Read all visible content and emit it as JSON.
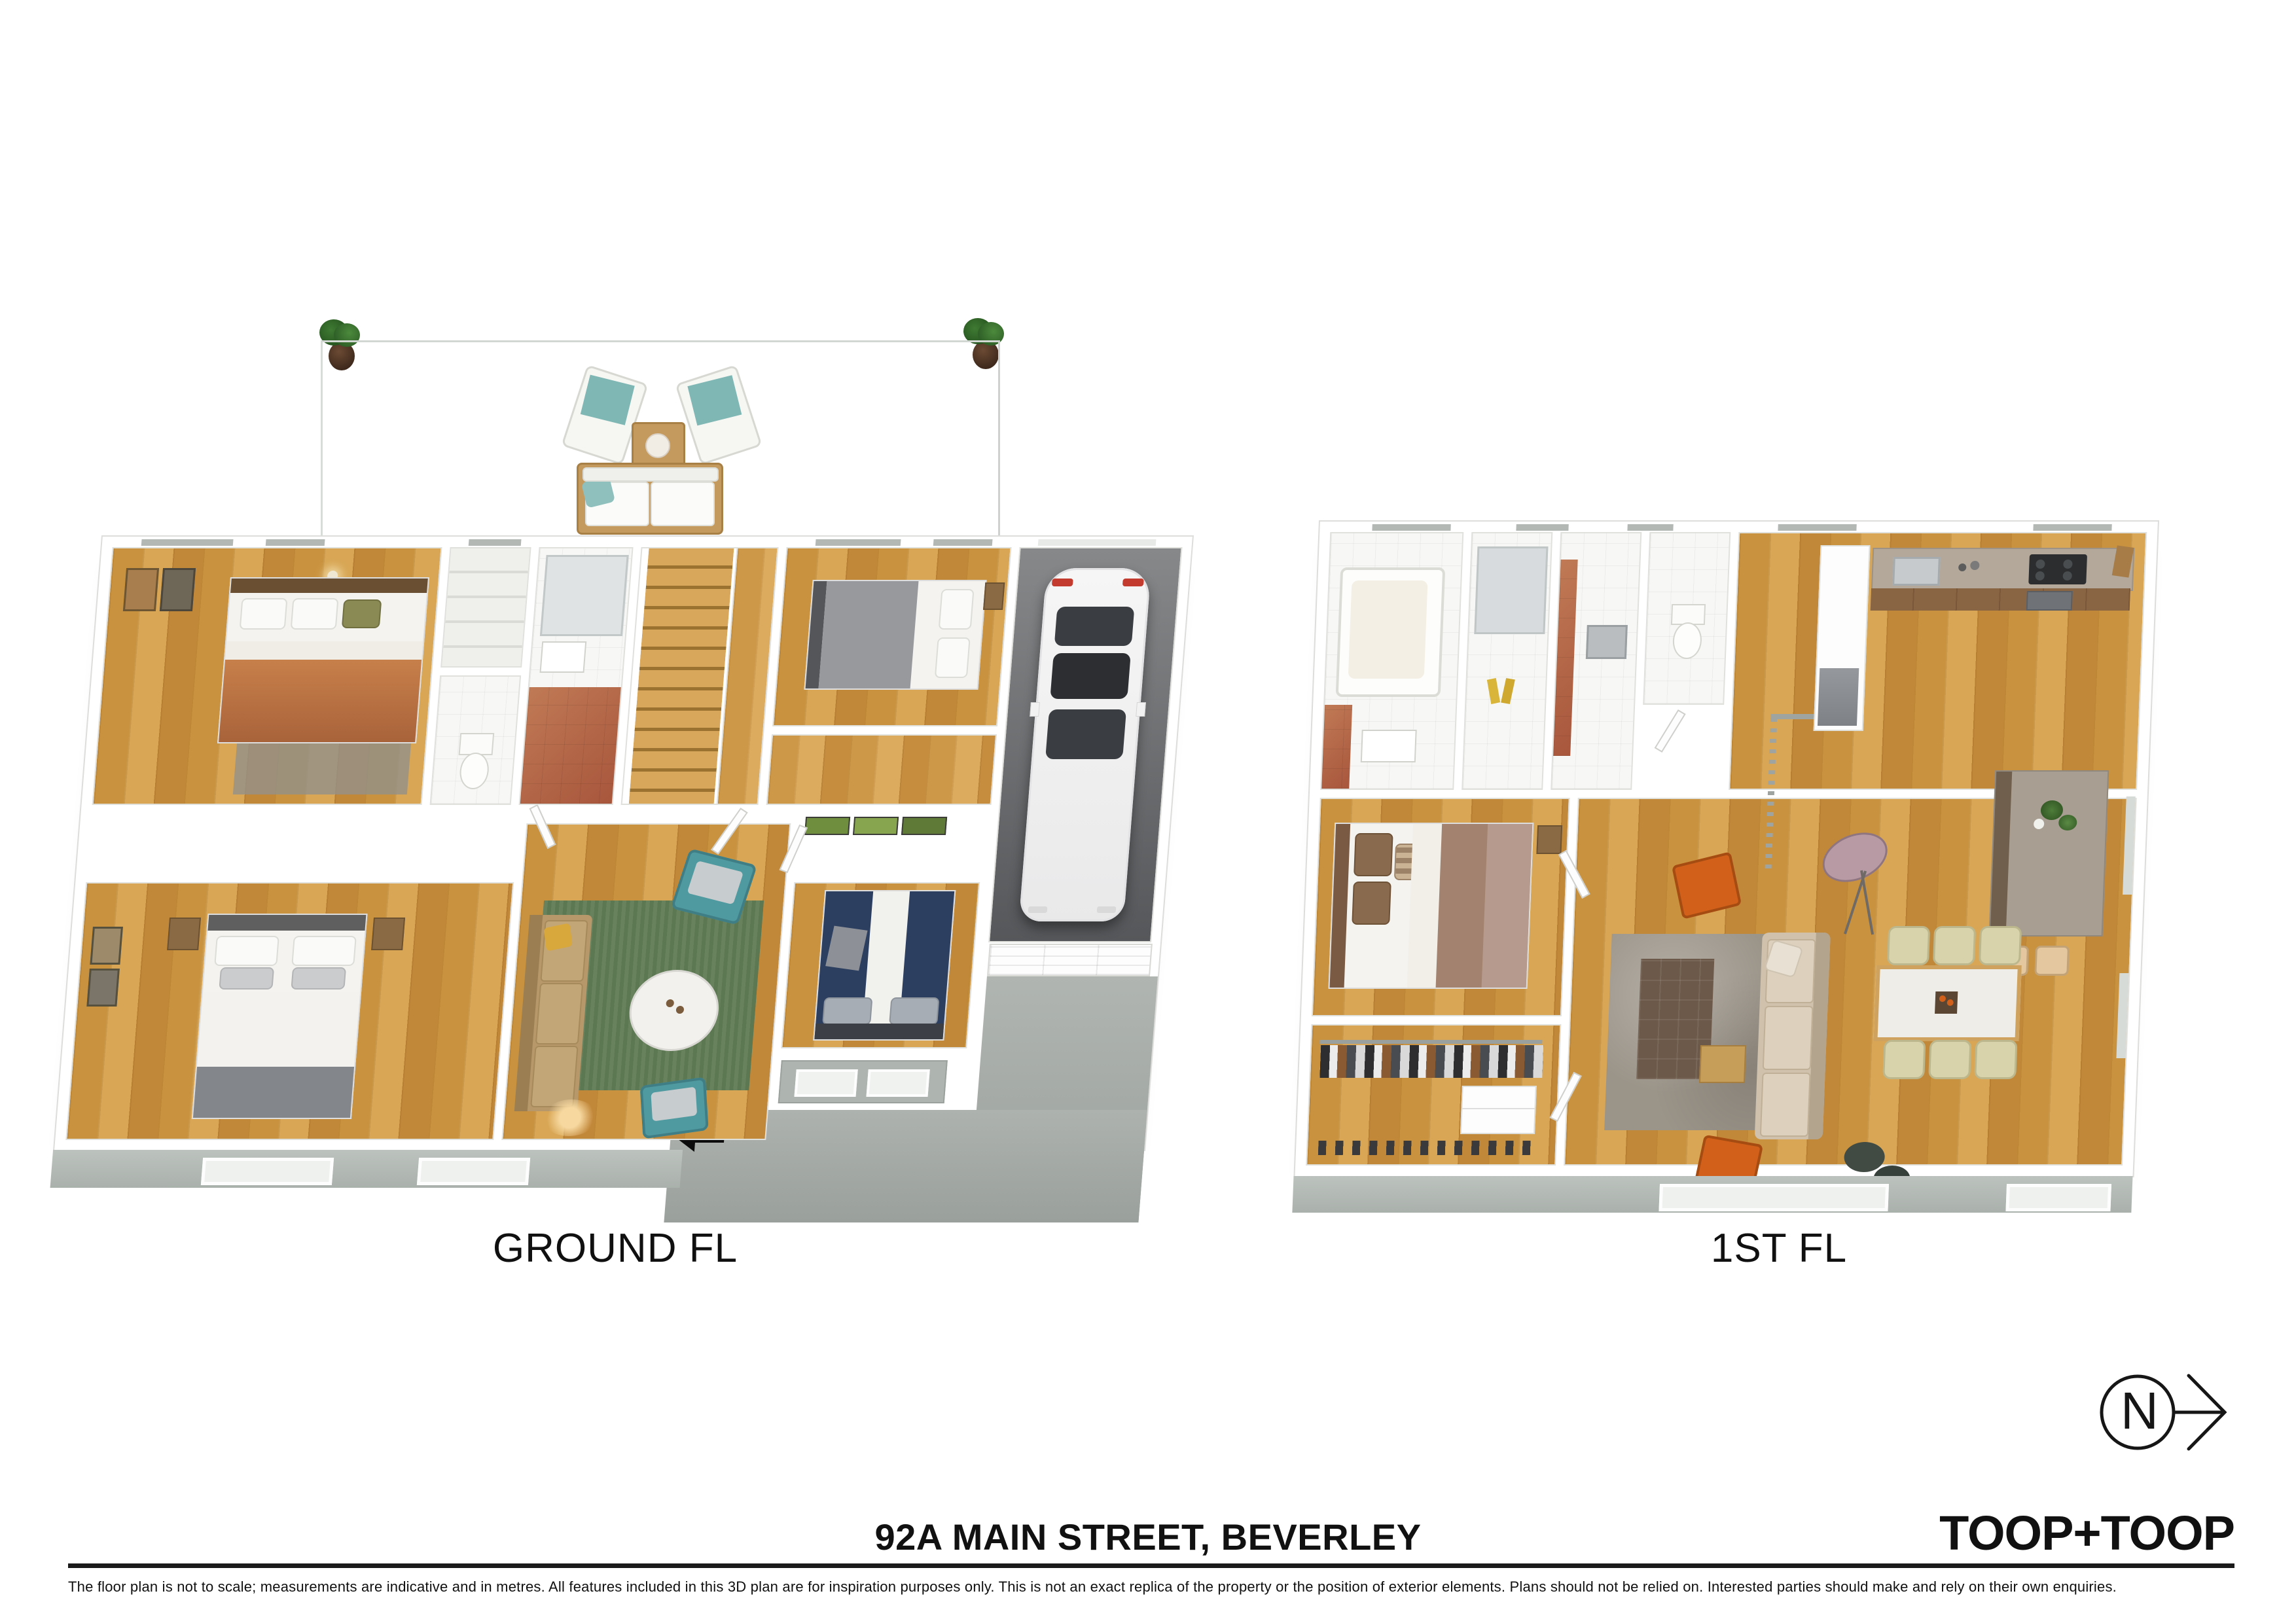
{
  "labels": {
    "ground": "GROUND FL",
    "first": "1ST FL"
  },
  "footer": {
    "address": "92A MAIN STREET, BEVERLEY",
    "brand": "TOOP+TOOP",
    "disclaimer": "The floor plan is not to scale; measurements are indicative and in metres. All features included in this 3D plan are for inspiration purposes only. This is not an exact replica of the property or the position of exterior elements. Plans should not be relied on. Interested parties should make and rely on their own enquiries."
  },
  "compass": {
    "letter": "N"
  },
  "palette": {
    "background": "#ffffff",
    "wood_floor": "#cf9a4b",
    "patio_concrete": "#e9ece9",
    "wall_white": "#ffffff",
    "exterior_skirt": "#b9bfba",
    "garage_floor": "#6a6c6e",
    "driveway": "#a7aca8",
    "teal_accent": "#4f9aa0",
    "rug_green": "#5c7852",
    "rug_grey": "#9b9489",
    "navy_bed": "#2c3f60",
    "tan_sofa": "#b6986a",
    "beige_sofa": "#cfc1ab",
    "orange_chair": "#d2601a",
    "terracotta": "#b4654a",
    "text": "#111111"
  }
}
